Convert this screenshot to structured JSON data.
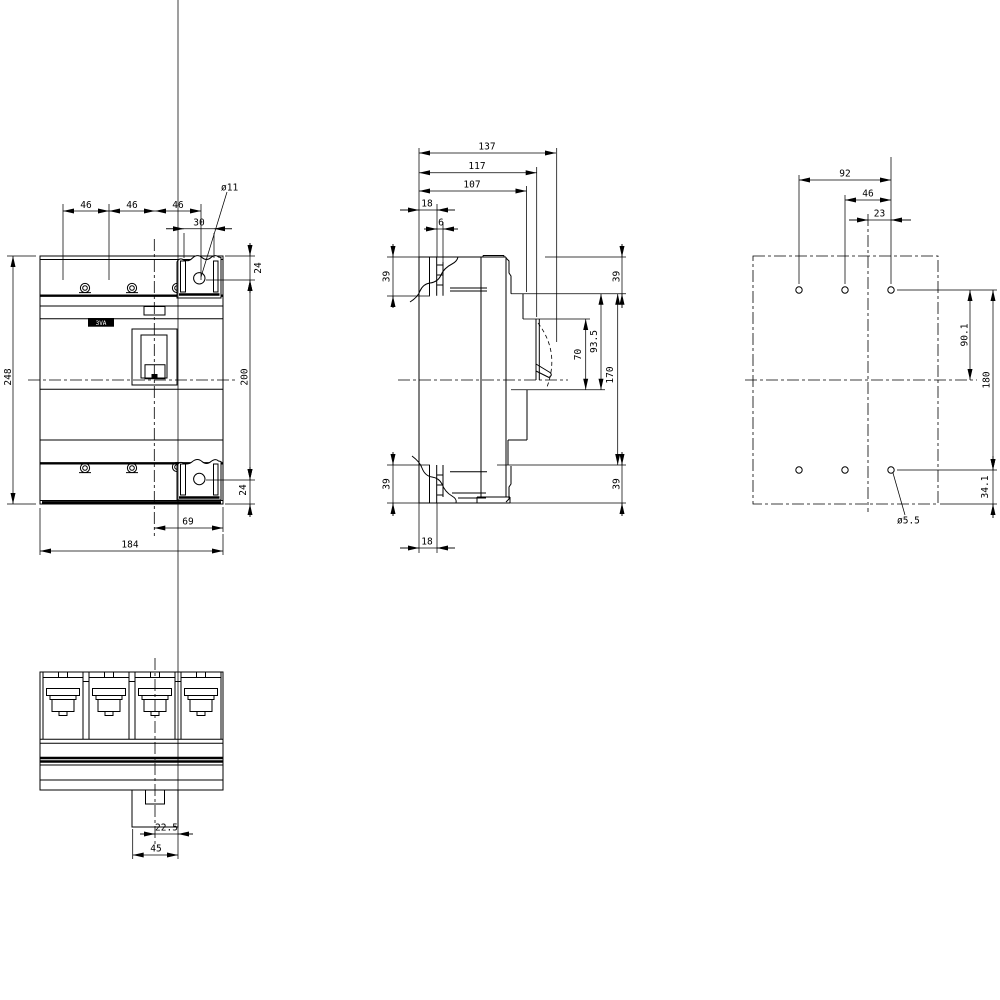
{
  "drawing": {
    "product_label": "3VA",
    "views": {
      "front": {
        "title": "front-view",
        "dims": {
          "pole_pitch_1": "46",
          "pole_pitch_2": "46",
          "pole_pitch_3": "46",
          "mount_hole_dia": "ø11",
          "tab_slot_span": "30",
          "hole_to_top": "24",
          "total_height": "248",
          "hole_spacing_vertical": "200",
          "hole_to_bottom": "24",
          "center_to_edge": "69",
          "total_width": "184"
        }
      },
      "side": {
        "title": "side-view",
        "dims": {
          "depth_total": "137",
          "depth_handle_dome": "117",
          "depth_cover": "107",
          "terminal_depth_top": "18",
          "rib_width": "6",
          "terminal_height_top_left": "39",
          "terminal_height_bottom_left": "39",
          "terminal_depth_bottom": "18",
          "handle_window_height": "70",
          "cover_step_height": "93.5",
          "front_section_height": "170",
          "step_top_right": "39",
          "step_bottom_right": "39"
        }
      },
      "plan": {
        "title": "drilling-plan",
        "dims": {
          "hole_span_horizontal": "92",
          "hole_pitch": "46",
          "center_offset": "23",
          "center_to_top_holes": "90.1",
          "hole_spacing_vertical": "180",
          "holes_to_bottom_edge": "34.1",
          "drill_hole_dia": "ø5.5"
        }
      },
      "bottom": {
        "title": "bottom-view",
        "dims": {
          "rail_center_offset": "22.5",
          "foot_width": "45"
        }
      }
    }
  }
}
